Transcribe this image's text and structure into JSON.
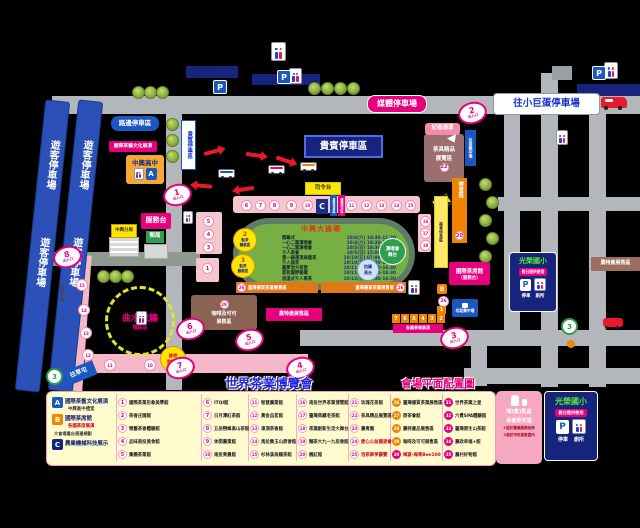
{
  "title": {
    "main": "世界茶業博覽會",
    "sub": "會場平面配置圖"
  },
  "colors": {
    "magenta": "#e6007e",
    "navy": "#16247d",
    "blue": "#1b57c0",
    "orange": "#f08300",
    "road": "#b3b7bb",
    "field": "#76b043",
    "band_blue": "#2b50b8",
    "legend_bg": "#fffbce"
  },
  "map": {
    "visitor_parking": "遊客停車場",
    "vip_parking": "貴賓停車區",
    "vip_parking_vertical": "貴賓停車區",
    "media_parking": "媒體停車場",
    "roadside_parking": "路邊停車區",
    "to_dome": "往小巨蛋停車場",
    "gate_label": "出入口",
    "gates": [
      "1",
      "2",
      "3",
      "4",
      "5",
      "6",
      "7",
      "8"
    ],
    "press_lane": "記者通道",
    "teaware": {
      "num": "22",
      "line1": "茶具精品",
      "line2": "展覽區"
    },
    "garbage_vertical": "垃圾集中場",
    "garbage_sign": "垃圾集中場",
    "school_a": {
      "name": "中興高中",
      "badge": "A"
    },
    "intl_tea_culture": "國際茶藝文化展演",
    "service_desk": "服務台",
    "police": "中興分局",
    "post_office": "郵局",
    "command_stage": "司令台",
    "road_name": "光華七路",
    "stadium": {
      "name": "中興大操場",
      "schedule": [
        {
          "event": "開幕式",
          "time": "10/4(六) 10:30-11:30"
        },
        {
          "event": "一心二葉演唱會",
          "time": "10/4(六) 18:30-20:30"
        },
        {
          "event": "一心二葉演唱會",
          "time": "10/5(日) 18:30-20:30"
        },
        {
          "event": "千人茶會",
          "time": "10/5(日) 15:00-17:30"
        },
        {
          "event": "第一鍋凍頂烏龍茶",
          "time": "10/10(五) 07:00-09:30"
        },
        {
          "event": "千人揉茶",
          "time": "10/10(五) 15:30-17:30"
        },
        {
          "event": "圓夢泡大茶壺",
          "time": "10/11(六) 10:30-16:30"
        },
        {
          "event": "茗校園野餐趣",
          "time": "10/11(六) 16:30-18:30"
        },
        {
          "event": "浪漫式千人奉茶",
          "time": "10/12(日) 15:30-16:30"
        }
      ],
      "stands_top": [
        "6",
        "7",
        "8",
        "9",
        "10"
      ],
      "stands_right": [
        "11",
        "12",
        "13",
        "14",
        "15"
      ],
      "c_badge": "C",
      "tag_blue": "貴賓休息區",
      "tag_pink": "媒體採訪區",
      "west_circles": [
        "5",
        "4",
        "3"
      ],
      "west_single": "1",
      "east_circles": [
        "16",
        "17",
        "18"
      ],
      "tea_zone_2": {
        "num": "2",
        "line1": "點茶",
        "line2": "體驗區"
      },
      "tea_zone_3": {
        "num": "3",
        "line1": "點茶",
        "line2": "體驗區"
      },
      "concert_stage": {
        "line1": "演唱會",
        "line2": "舞台"
      },
      "photo_tower": {
        "line1": "拍攝",
        "line2": "高台"
      },
      "strip_left": {
        "num": "26",
        "label": "臺灣優質茶葉展售區"
      },
      "strip_right": {
        "num": "26",
        "label": "臺灣優質茶葉展售區"
      }
    },
    "food_zone": {
      "num": "20",
      "label": "美食區"
    },
    "food_rest": "美食休息區",
    "tea_house": {
      "line1": "國際茶席館",
      "line2": "（服務台）"
    },
    "booth_b": {
      "badge": "B",
      "circle": "26",
      "single": "1",
      "row": [
        "7",
        "6",
        "5",
        "4",
        "3",
        "2"
      ],
      "label": "各國茶席展演"
    },
    "coffee": {
      "num": "29",
      "line1": "咖啡及可可",
      "line2": "展售區"
    },
    "farm_bar": "農特產展售區",
    "farm_bar_right": "農特產展售區",
    "yellow_zone": {
      "line1": "曲水流觴",
      "line2": "體驗區"
    },
    "medical": {
      "line1": "醫療",
      "line2": "救護站"
    },
    "road_circles": [
      "15",
      "14",
      "13",
      "12",
      "11",
      "10"
    ],
    "route3": "3",
    "to_caotun": "往草屯",
    "school_sign": {
      "name": "光榮國小",
      "chip": "假日提供使用",
      "p": "P",
      "parking": "停車",
      "toilet": "廁所"
    }
  },
  "legend": {
    "abc": [
      {
        "badge": "A",
        "line1": "國際茶藝文化展演",
        "line2": "中興高中禮堂",
        "line3": ""
      },
      {
        "badge": "B",
        "line1": "國際茶席館",
        "line2": "各國茶席展演",
        "line3": "大會場看台周邊規劃"
      },
      {
        "badge": "C",
        "line1": "農業機械科技展示",
        "line2": "",
        "line3": ""
      }
    ],
    "columns": [
      {
        "items": [
          {
            "n": "1",
            "t": "國際茶業形象美學館"
          },
          {
            "n": "2",
            "t": "茶香庄園館"
          },
          {
            "n": "3",
            "t": "懷舊茶香體驗館"
          },
          {
            "n": "4",
            "t": "品味南投美食館"
          },
          {
            "n": "5",
            "t": "集團茶業館"
          }
        ]
      },
      {
        "items": [
          {
            "n": "6",
            "t": "ITQI館"
          },
          {
            "n": "7",
            "t": "日月潭紅茶館"
          },
          {
            "n": "8",
            "t": "五岳巒峰高山茶館"
          },
          {
            "n": "9",
            "t": "休閒農業館"
          },
          {
            "n": "10",
            "t": "南投青農館"
          }
        ]
      },
      {
        "items": [
          {
            "n": "11",
            "t": "智慧農業館"
          },
          {
            "n": "12",
            "t": "黃金品茗館"
          },
          {
            "n": "13",
            "t": "凍頂茶香館"
          },
          {
            "n": "14",
            "t": "馬拉桑玉山原香館"
          },
          {
            "n": "15",
            "t": "杉林溪烏龍茶館"
          }
        ]
      },
      {
        "items": [
          {
            "n": "16",
            "t": "南投世界茶業博覽館"
          },
          {
            "n": "17",
            "t": "臺灣典藏老茶館"
          },
          {
            "n": "18",
            "t": "茶葉創新生活大舞台"
          },
          {
            "n": "19",
            "t": "麵茶大九一九炭香館"
          },
          {
            "n": "20",
            "t": "楓紅館"
          }
        ]
      },
      {
        "items": [
          {
            "n": "21",
            "t": "玫瑰花茶館"
          },
          {
            "n": "22",
            "t": "茶具精品展覽區"
          },
          {
            "n": "23",
            "t": "農青園"
          },
          {
            "n": "24",
            "t": "愛心公益園遊會",
            "red": true
          },
          {
            "n": "25",
            "t": "泡茶師爭霸賽",
            "red": true
          }
        ]
      },
      {
        "items": [
          {
            "n": "26",
            "t": "臺灣優質茶葉展售區",
            "style": "or"
          },
          {
            "n": "27",
            "t": "原茶會館",
            "style": "or"
          },
          {
            "n": "28",
            "t": "農特產品展售區",
            "style": "or"
          },
          {
            "n": "29",
            "t": "咖啡及可可展售區",
            "style": "or"
          },
          {
            "n": "30",
            "t": "梅宴·梅青Bee100",
            "style": "mg",
            "red": true
          }
        ]
      },
      {
        "items": [
          {
            "n": "31",
            "t": "世界茶葉之星",
            "style": "mg"
          },
          {
            "n": "32",
            "t": "六覺SPA體驗館",
            "style": "mg"
          },
          {
            "n": "33",
            "t": "臺灣原生山茶館",
            "style": "mg"
          },
          {
            "n": "34",
            "t": "農政幸福+館",
            "style": "mg"
          },
          {
            "n": "35",
            "t": "農村好物館",
            "style": "mg"
          }
        ]
      }
    ],
    "nursing": {
      "line1": "哺(集)乳室",
      "line2": "長者更衣室",
      "note1": "①設於農業服務站旁",
      "note2": "②設於可可展售區內"
    },
    "school_panel": {
      "name": "光榮國小",
      "chip": "假日提供使用",
      "p": "P",
      "parking": "停車",
      "toilet": "廁所"
    }
  }
}
